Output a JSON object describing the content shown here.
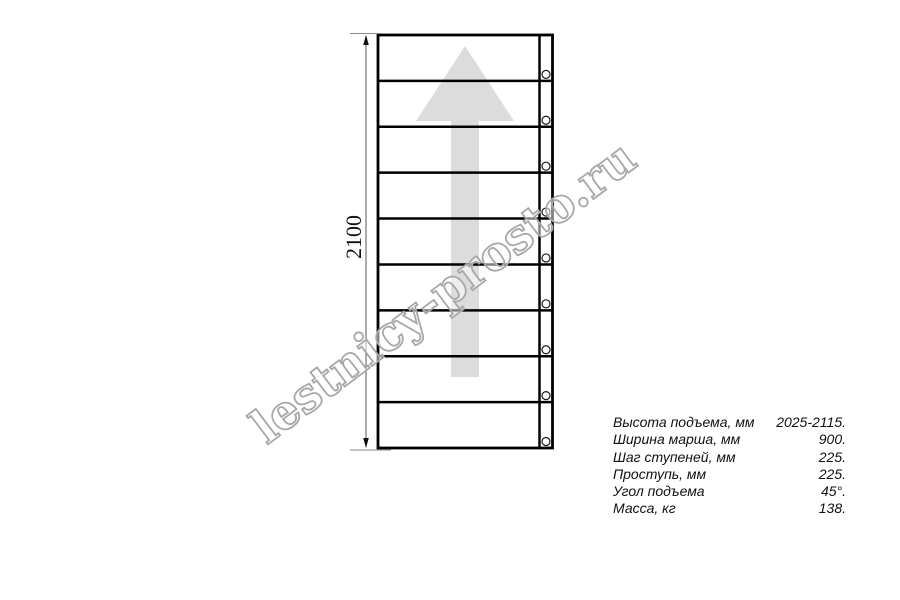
{
  "drawing": {
    "type": "stair-flight-plan-view",
    "dimension_label": "2100",
    "step_count": 9,
    "watermark": "lestnicy-prosto.ru",
    "colors": {
      "line": "#000000",
      "direction_arrow": "#dcdcdc",
      "watermark_outline": "#a8a8a8",
      "dimension_line": "#5a5a5a"
    }
  },
  "specs": {
    "rows": [
      {
        "label": "Высота подъема, мм",
        "value": "2025-2115."
      },
      {
        "label": "Ширина марша, мм",
        "value": "900."
      },
      {
        "label": "Шаг ступеней, мм",
        "value": "225."
      },
      {
        "label": "Проступь, мм",
        "value": "225."
      },
      {
        "label": "Угол подъема",
        "value": "45°."
      },
      {
        "label": "Масса, кг",
        "value": "138."
      }
    ]
  }
}
